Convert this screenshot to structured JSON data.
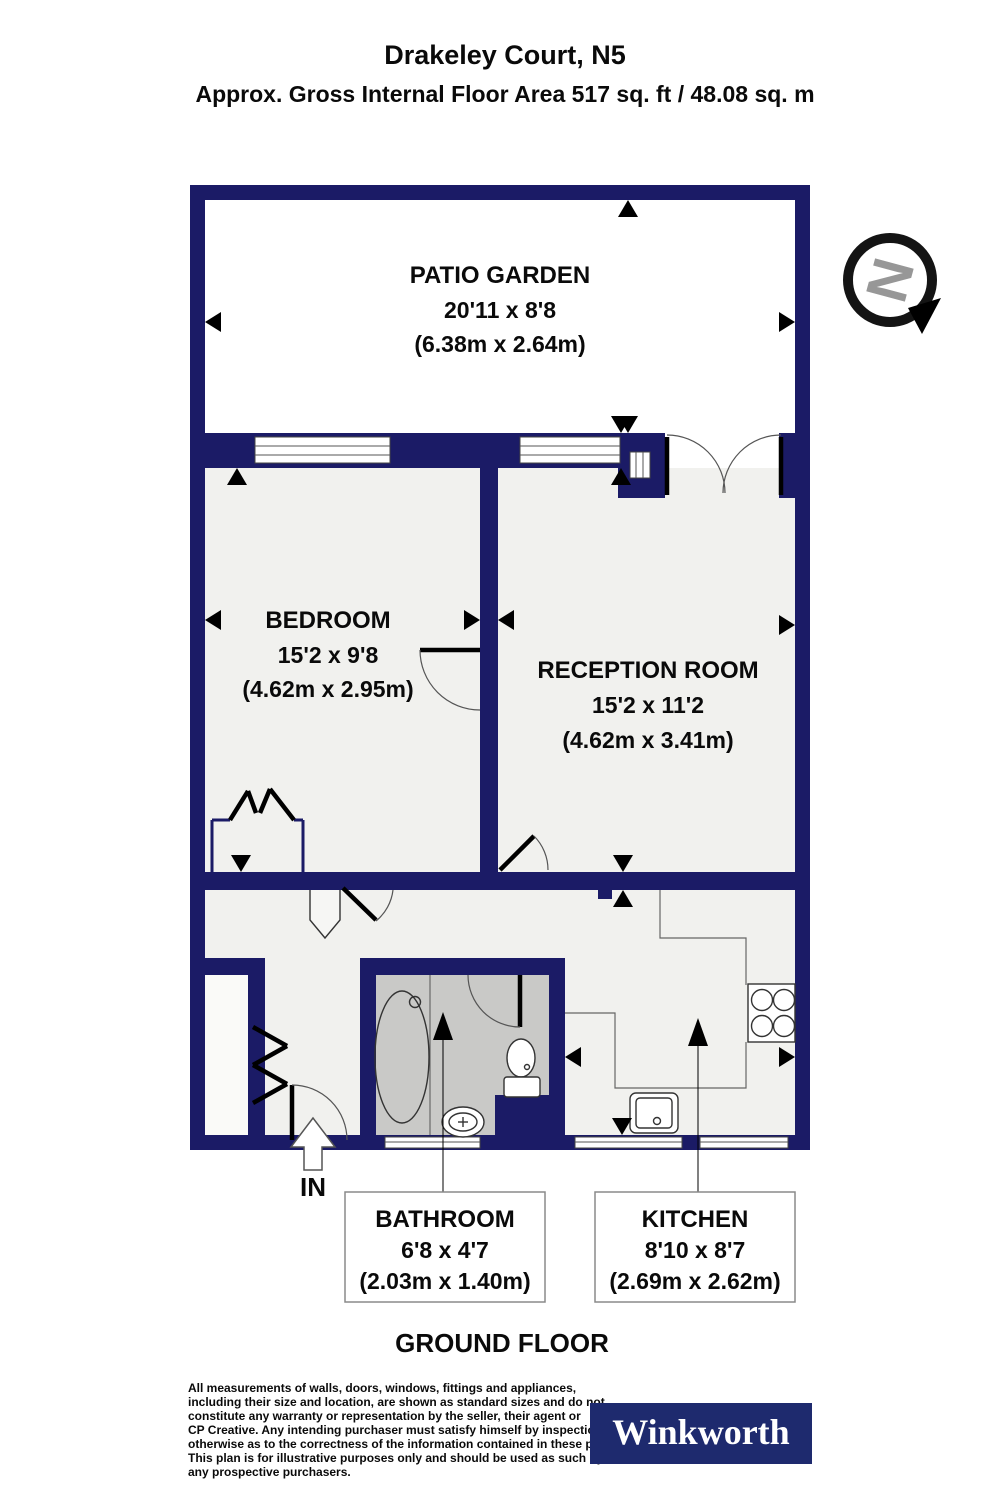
{
  "header": {
    "title": "Drakeley Court, N5",
    "subtitle": "Approx. Gross Internal Floor Area 517 sq. ft / 48.08 sq. m"
  },
  "rooms": {
    "patio": {
      "name": "PATIO GARDEN",
      "imperial": "20'11 x 8'8",
      "metric": "(6.38m x 2.64m)"
    },
    "bedroom": {
      "name": "BEDROOM",
      "imperial": "15'2 x 9'8",
      "metric": "(4.62m x 2.95m)"
    },
    "reception": {
      "name": "RECEPTION ROOM",
      "imperial": "15'2 x 11'2",
      "metric": "(4.62m x 3.41m)"
    },
    "bathroom": {
      "name": "BATHROOM",
      "imperial": "6'8 x 4'7",
      "metric": "(2.03m x 1.40m)"
    },
    "kitchen": {
      "name": "KITCHEN",
      "imperial": "8'10 x 8'7",
      "metric": "(2.69m x 2.62m)"
    }
  },
  "entrance_label": "IN",
  "floor_label": "GROUND FLOOR",
  "compass": {
    "letter": "N"
  },
  "disclaimer": {
    "lines": [
      "All measurements of walls, doors, windows, fittings and appliances,",
      "including their size and location, are shown as standard sizes and do not",
      "constitute any warranty or representation by the seller, their agent or",
      "CP Creative. Any intending purchaser must satisfy himself by inspection or",
      "otherwise as to the correctness of the information contained in these plans.",
      "This plan is for illustrative purposes only and should be used as such by",
      "any prospective purchasers."
    ]
  },
  "brand": {
    "name": "Winkworth"
  },
  "colors": {
    "wall": "#1b1b66",
    "logo_bg": "#1e2a6e",
    "bathroom_floor": "#c9c9c7",
    "room_floor": "#f1f1ee",
    "patio_floor": "#ffffff"
  }
}
